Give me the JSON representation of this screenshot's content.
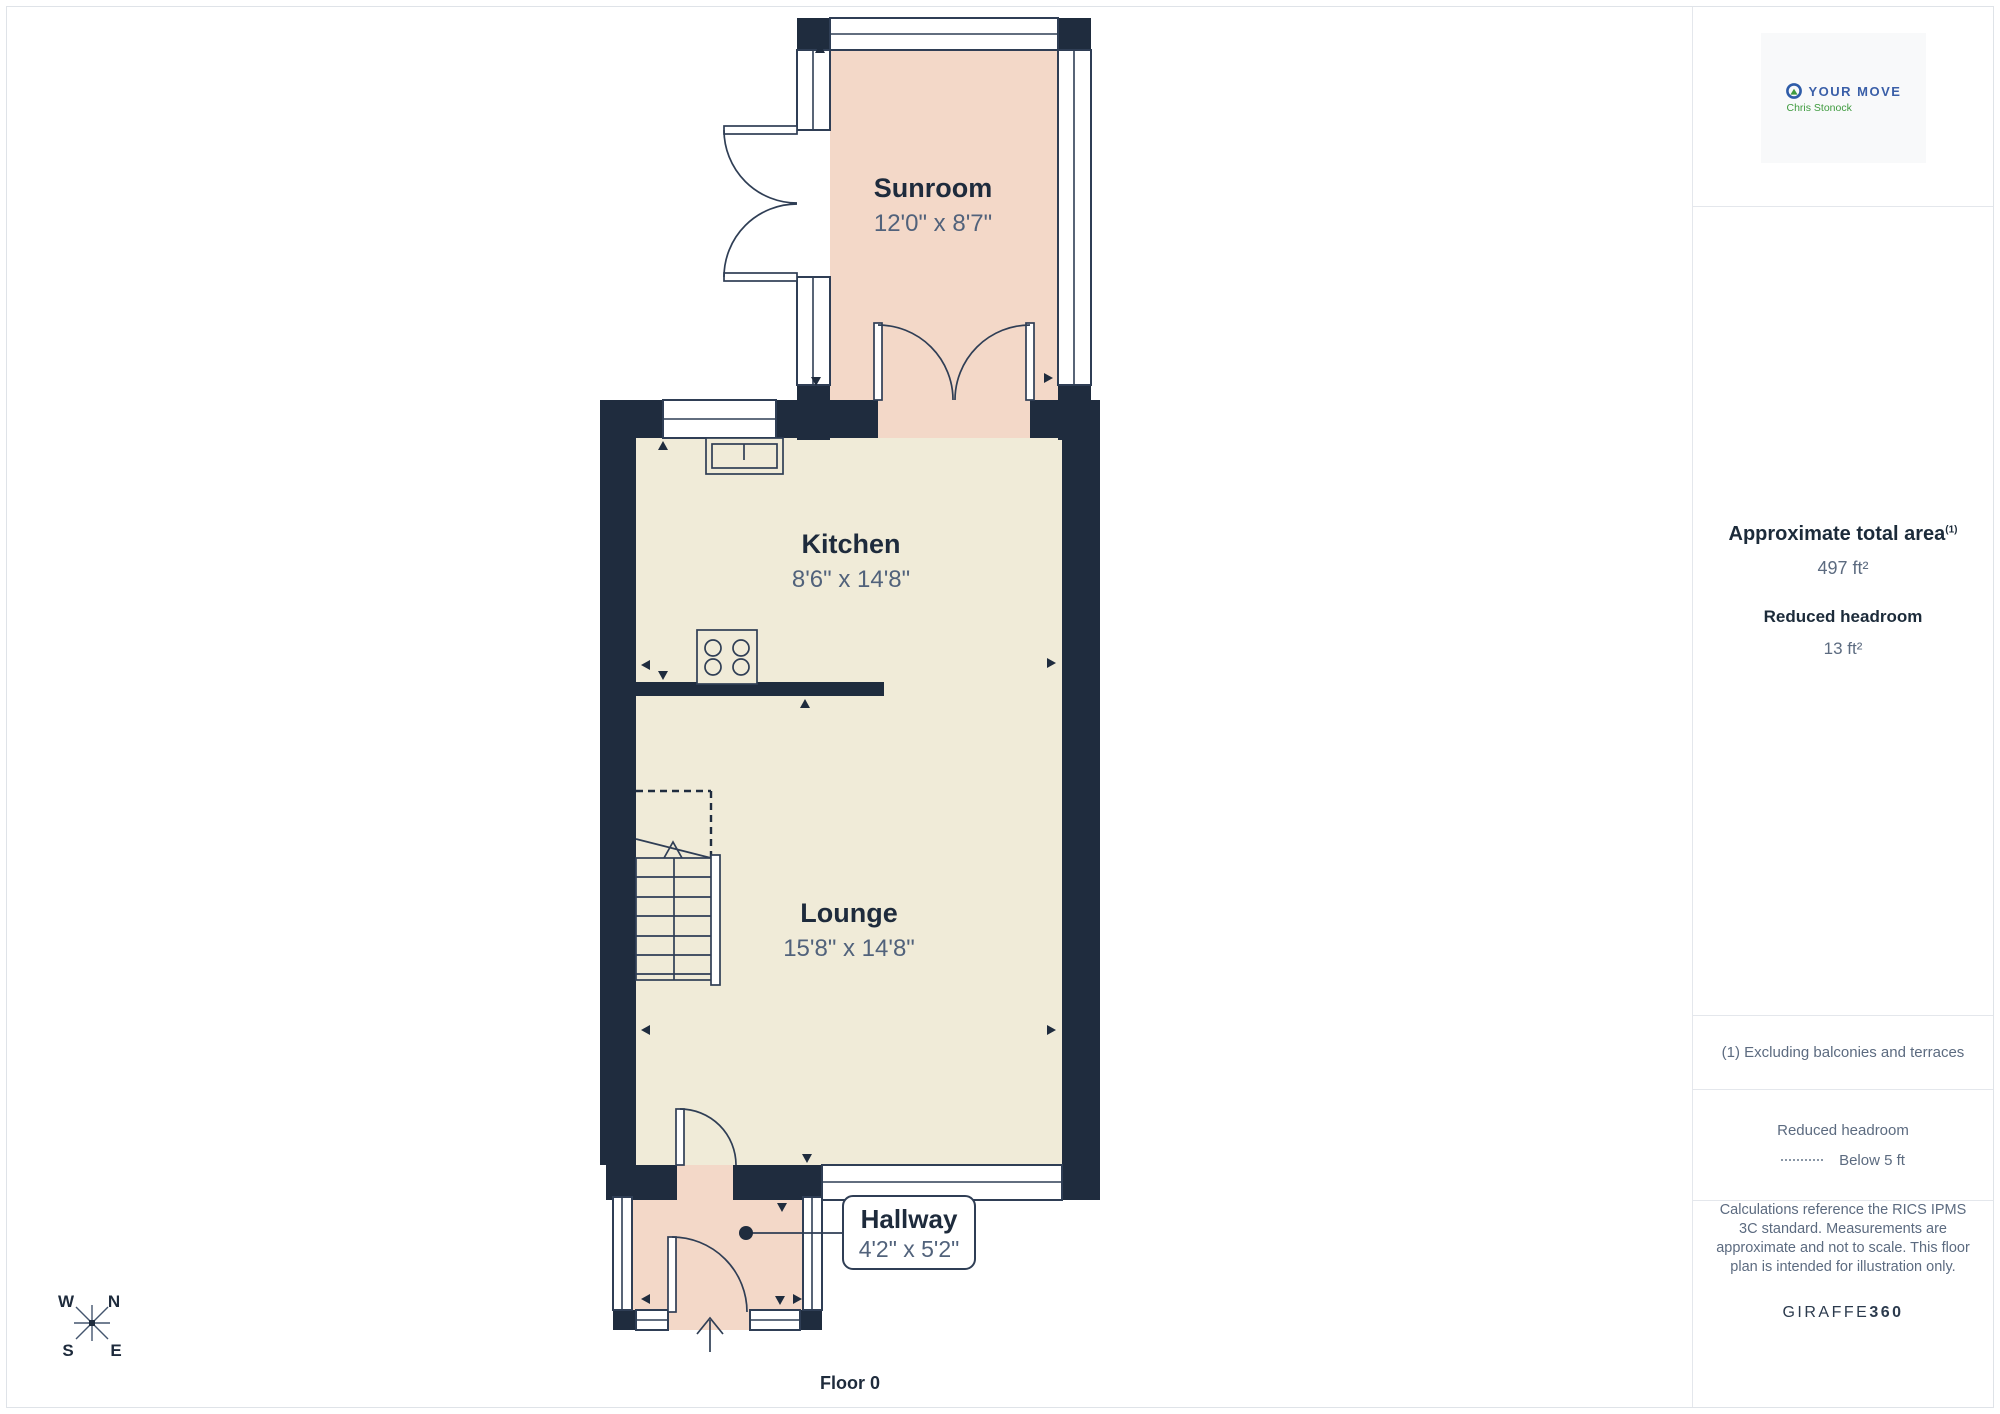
{
  "plan": {
    "floor_label": "Floor 0",
    "rooms": {
      "sunroom": {
        "name": "Sunroom",
        "dims": "12'0\" x 8'7\""
      },
      "kitchen": {
        "name": "Kitchen",
        "dims": "8'6\" x 14'8\""
      },
      "lounge": {
        "name": "Lounge",
        "dims": "15'8\" x 14'8\""
      },
      "hallway": {
        "name": "Hallway",
        "dims": "4'2\" x 5'2\""
      }
    },
    "compass": {
      "n": "N",
      "s": "S",
      "e": "E",
      "w": "W"
    }
  },
  "sidebar": {
    "logo": {
      "brand": "YOUR MOVE",
      "agent": "Chris Stonock"
    },
    "area": {
      "title": "Approximate total area",
      "title_sup": "(1)",
      "value": "497 ft²",
      "reduced_title": "Reduced headroom",
      "reduced_value": "13 ft²"
    },
    "footnote": "(1) Excluding balconies and terraces",
    "legend": {
      "title": "Reduced headroom",
      "item": "Below 5 ft"
    },
    "disclaimer": "Calculations reference the RICS IPMS 3C standard. Measurements are approximate and not to scale. This floor plan is intended for illustration only.",
    "brand": {
      "name": "GIRAFFE",
      "suffix": "360"
    }
  },
  "colors": {
    "wall": "#1f2c3e",
    "floor_cream": "#f0ebd8",
    "floor_pink": "#f3d8c8",
    "accent_blue": "#3a5fa8",
    "accent_green": "#3f9b3f",
    "text_dark": "#1c2b3a",
    "text_gray": "#5c6b80"
  }
}
